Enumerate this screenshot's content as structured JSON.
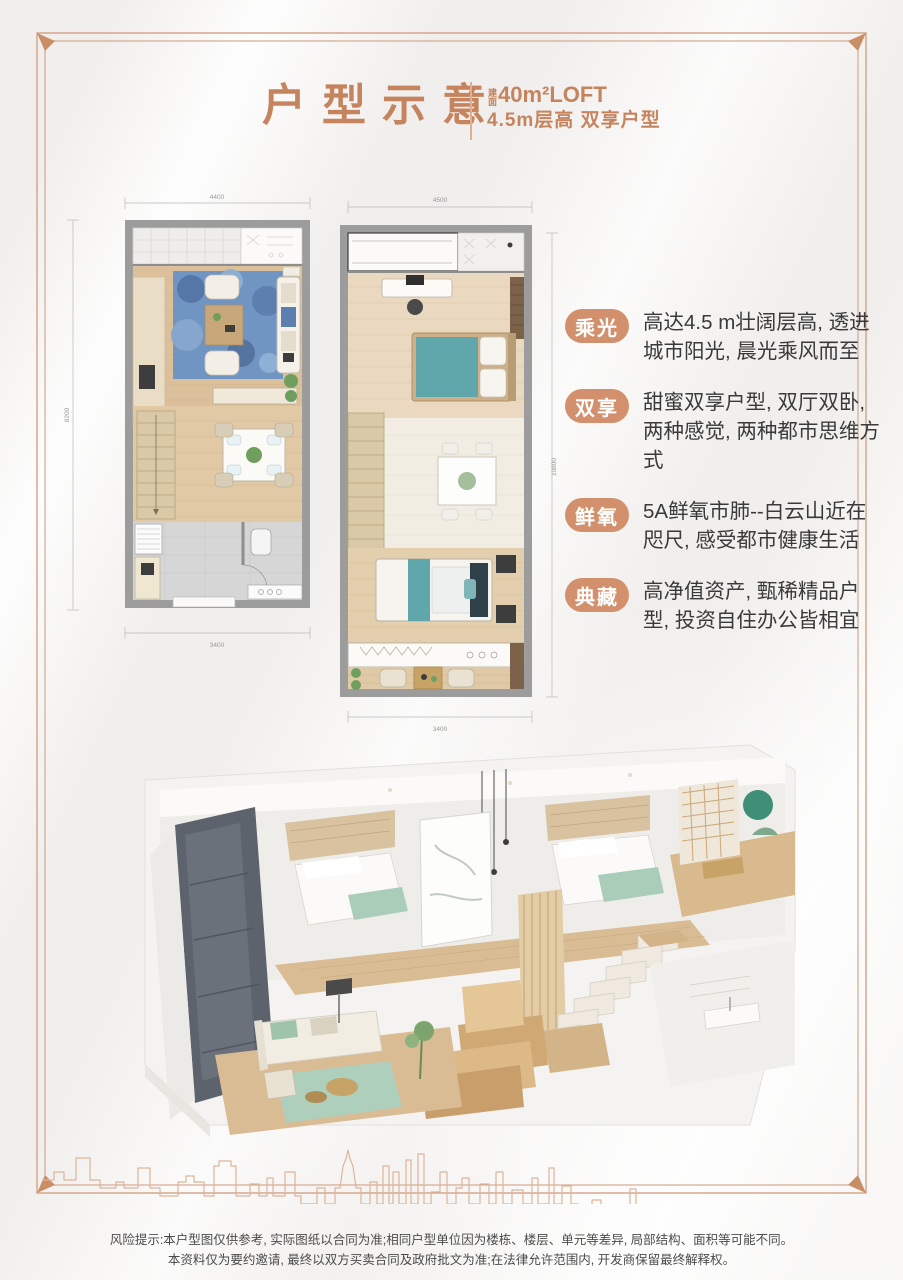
{
  "header": {
    "title": "户型示意",
    "area_prefix": "建面",
    "subtitle_line1": "40m²LOFT",
    "subtitle_line2": "4.5m层高 双享户型",
    "accent_color": "#c5835e"
  },
  "plans": {
    "left": {
      "dim_top": "4400",
      "dim_left": "8200",
      "dim_bottom": "3400"
    },
    "right": {
      "dim_top": "4500",
      "dim_right": "10800",
      "dim_bottom": "3400"
    }
  },
  "features": [
    {
      "badge": "乘光",
      "text": "高达4.5 m壮阔层高, 透进城市阳光, 晨光乘风而至"
    },
    {
      "badge": "双享",
      "text": "甜蜜双享户型, 双厅双卧, 两种感觉, 两种都市思维方式"
    },
    {
      "badge": "鲜氧",
      "text": "5A鲜氧市肺--白云山近在咫尺, 感受都市健康生活"
    },
    {
      "badge": "典藏",
      "text": "高净值资产, 甄稀精品户型, 投资自住办公皆相宜"
    }
  ],
  "badge_color": "#d2916c",
  "frame_color": "#d3a284",
  "skyline_color": "#ddb49a",
  "disclaimer": {
    "line1": "风险提示:本户型图仅供参考, 实际图纸以合同为准;相同户型单位因为楼栋、楼层、单元等差异, 局部结构、面积等可能不同。",
    "line2": "本资料仅为要约邀请, 最终以双方买卖合同及政府批文为准;在法律允许范围内, 开发商保留最终解释权。"
  }
}
